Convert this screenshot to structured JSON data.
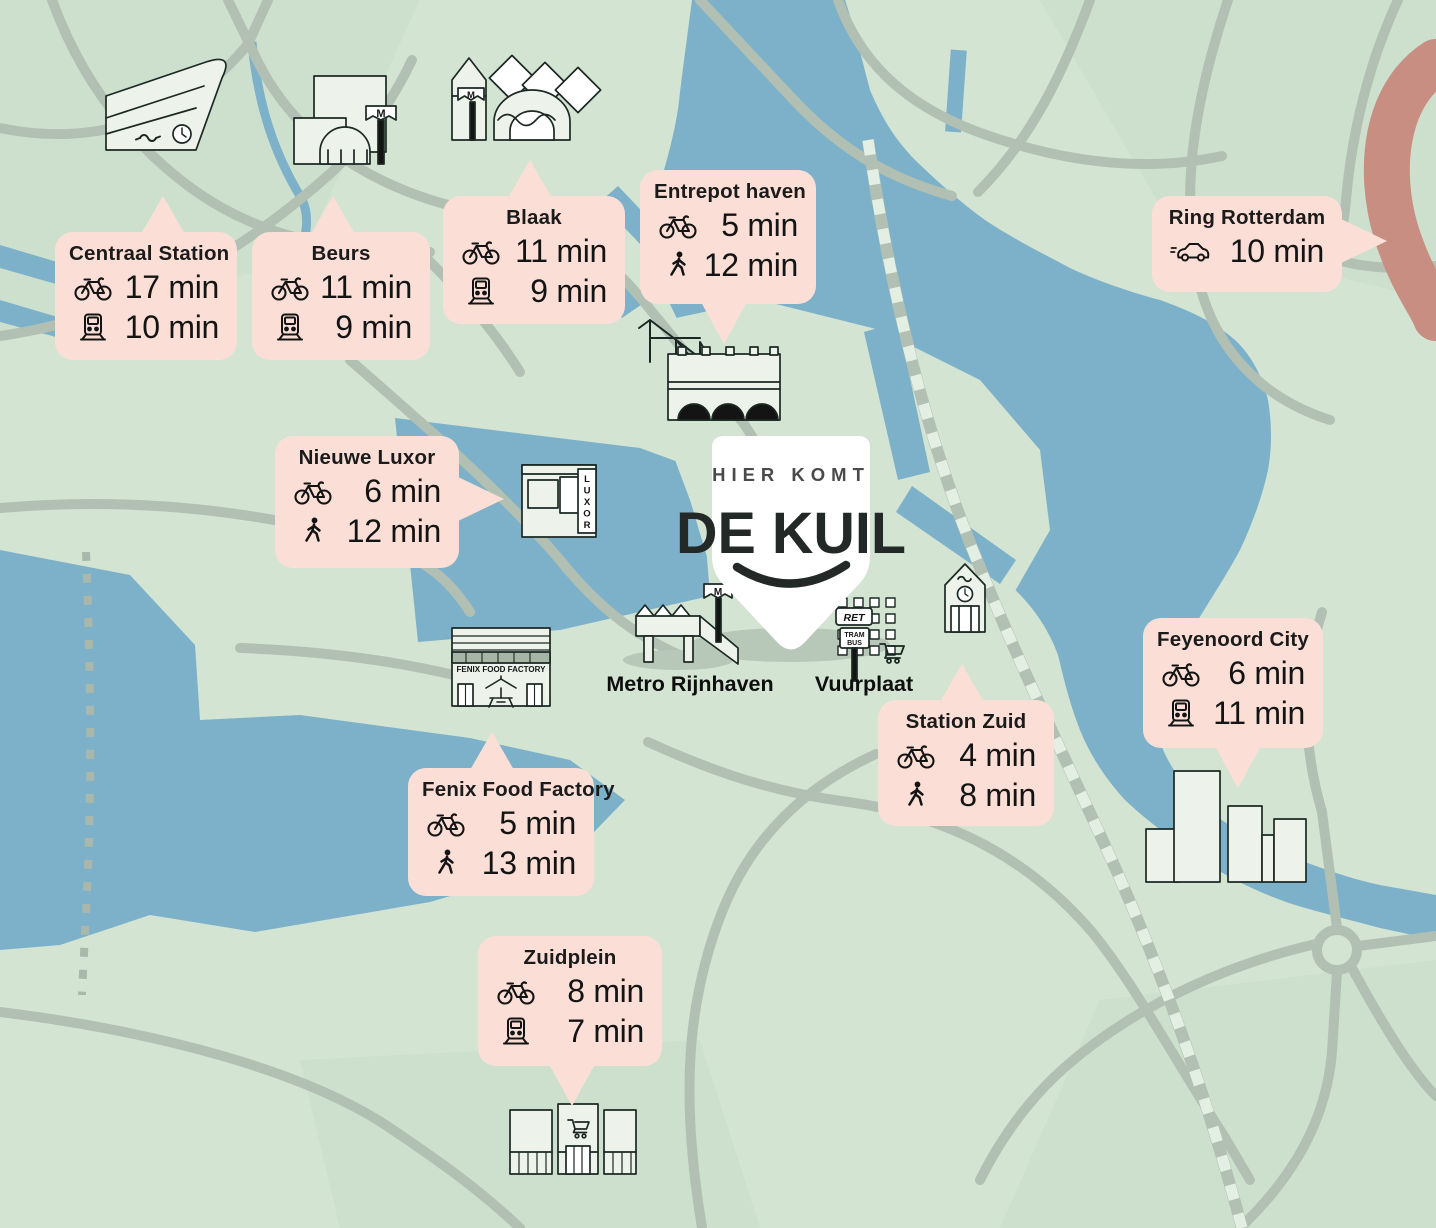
{
  "marker": {
    "eyebrow": "HIER KOMT",
    "title": "DE KUIL"
  },
  "map_labels": {
    "metro": "Metro Rijnhaven",
    "vuurplaat": "Vuurplaat"
  },
  "building_texts": {
    "luxor": "LUXOR",
    "fenix": "FENIX FOOD FACTORY",
    "ret": "RET",
    "tram": "TRAM",
    "bus": "BUS",
    "metro_flag": "M"
  },
  "callouts": [
    {
      "id": "centraal-station",
      "title": "Centraal Station",
      "rows": [
        {
          "icon": "bike-icon",
          "value": "17 min"
        },
        {
          "icon": "metro-icon",
          "value": "10 min"
        }
      ]
    },
    {
      "id": "beurs",
      "title": "Beurs",
      "rows": [
        {
          "icon": "bike-icon",
          "value": "11 min"
        },
        {
          "icon": "metro-icon",
          "value": "9 min"
        }
      ]
    },
    {
      "id": "blaak",
      "title": "Blaak",
      "rows": [
        {
          "icon": "bike-icon",
          "value": "11 min"
        },
        {
          "icon": "metro-icon",
          "value": "9 min"
        }
      ]
    },
    {
      "id": "entrepot-haven",
      "title": "Entrepot haven",
      "rows": [
        {
          "icon": "bike-icon",
          "value": "5 min"
        },
        {
          "icon": "walk-icon",
          "value": "12 min"
        }
      ]
    },
    {
      "id": "ring-rotterdam",
      "title": "Ring Rotterdam",
      "rows": [
        {
          "icon": "car-icon",
          "value": "10 min"
        }
      ]
    },
    {
      "id": "nieuwe-luxor",
      "title": "Nieuwe Luxor",
      "rows": [
        {
          "icon": "bike-icon",
          "value": "6 min"
        },
        {
          "icon": "walk-icon",
          "value": "12 min"
        }
      ]
    },
    {
      "id": "fenix-food-factory",
      "title": "Fenix Food Factory",
      "rows": [
        {
          "icon": "bike-icon",
          "value": "5 min"
        },
        {
          "icon": "walk-icon",
          "value": "13 min"
        }
      ]
    },
    {
      "id": "station-zuid",
      "title": "Station Zuid",
      "rows": [
        {
          "icon": "bike-icon",
          "value": "4 min"
        },
        {
          "icon": "walk-icon",
          "value": "8 min"
        }
      ]
    },
    {
      "id": "feyenoord-city",
      "title": "Feyenoord City",
      "rows": [
        {
          "icon": "bike-icon",
          "value": "6 min"
        },
        {
          "icon": "metro-icon",
          "value": "11 min"
        }
      ]
    },
    {
      "id": "zuidplein",
      "title": "Zuidplein",
      "rows": [
        {
          "icon": "bike-icon",
          "value": "8 min"
        },
        {
          "icon": "metro-icon",
          "value": "7 min"
        }
      ]
    }
  ],
  "colors": {
    "water": "#7db1c9",
    "land": "#d3e4d2",
    "land_shade": "#c8dcc9",
    "road": "#b2c0b3",
    "railway_dash": "#e4efe3",
    "ring_road": "#c98e82",
    "callout_bg": "#fbdfd7",
    "building_fill": "#edf3ea",
    "outline": "#1b2823",
    "pin_fill": "#ffffff",
    "text": "#141414",
    "shadow": "#b7c8b8"
  }
}
